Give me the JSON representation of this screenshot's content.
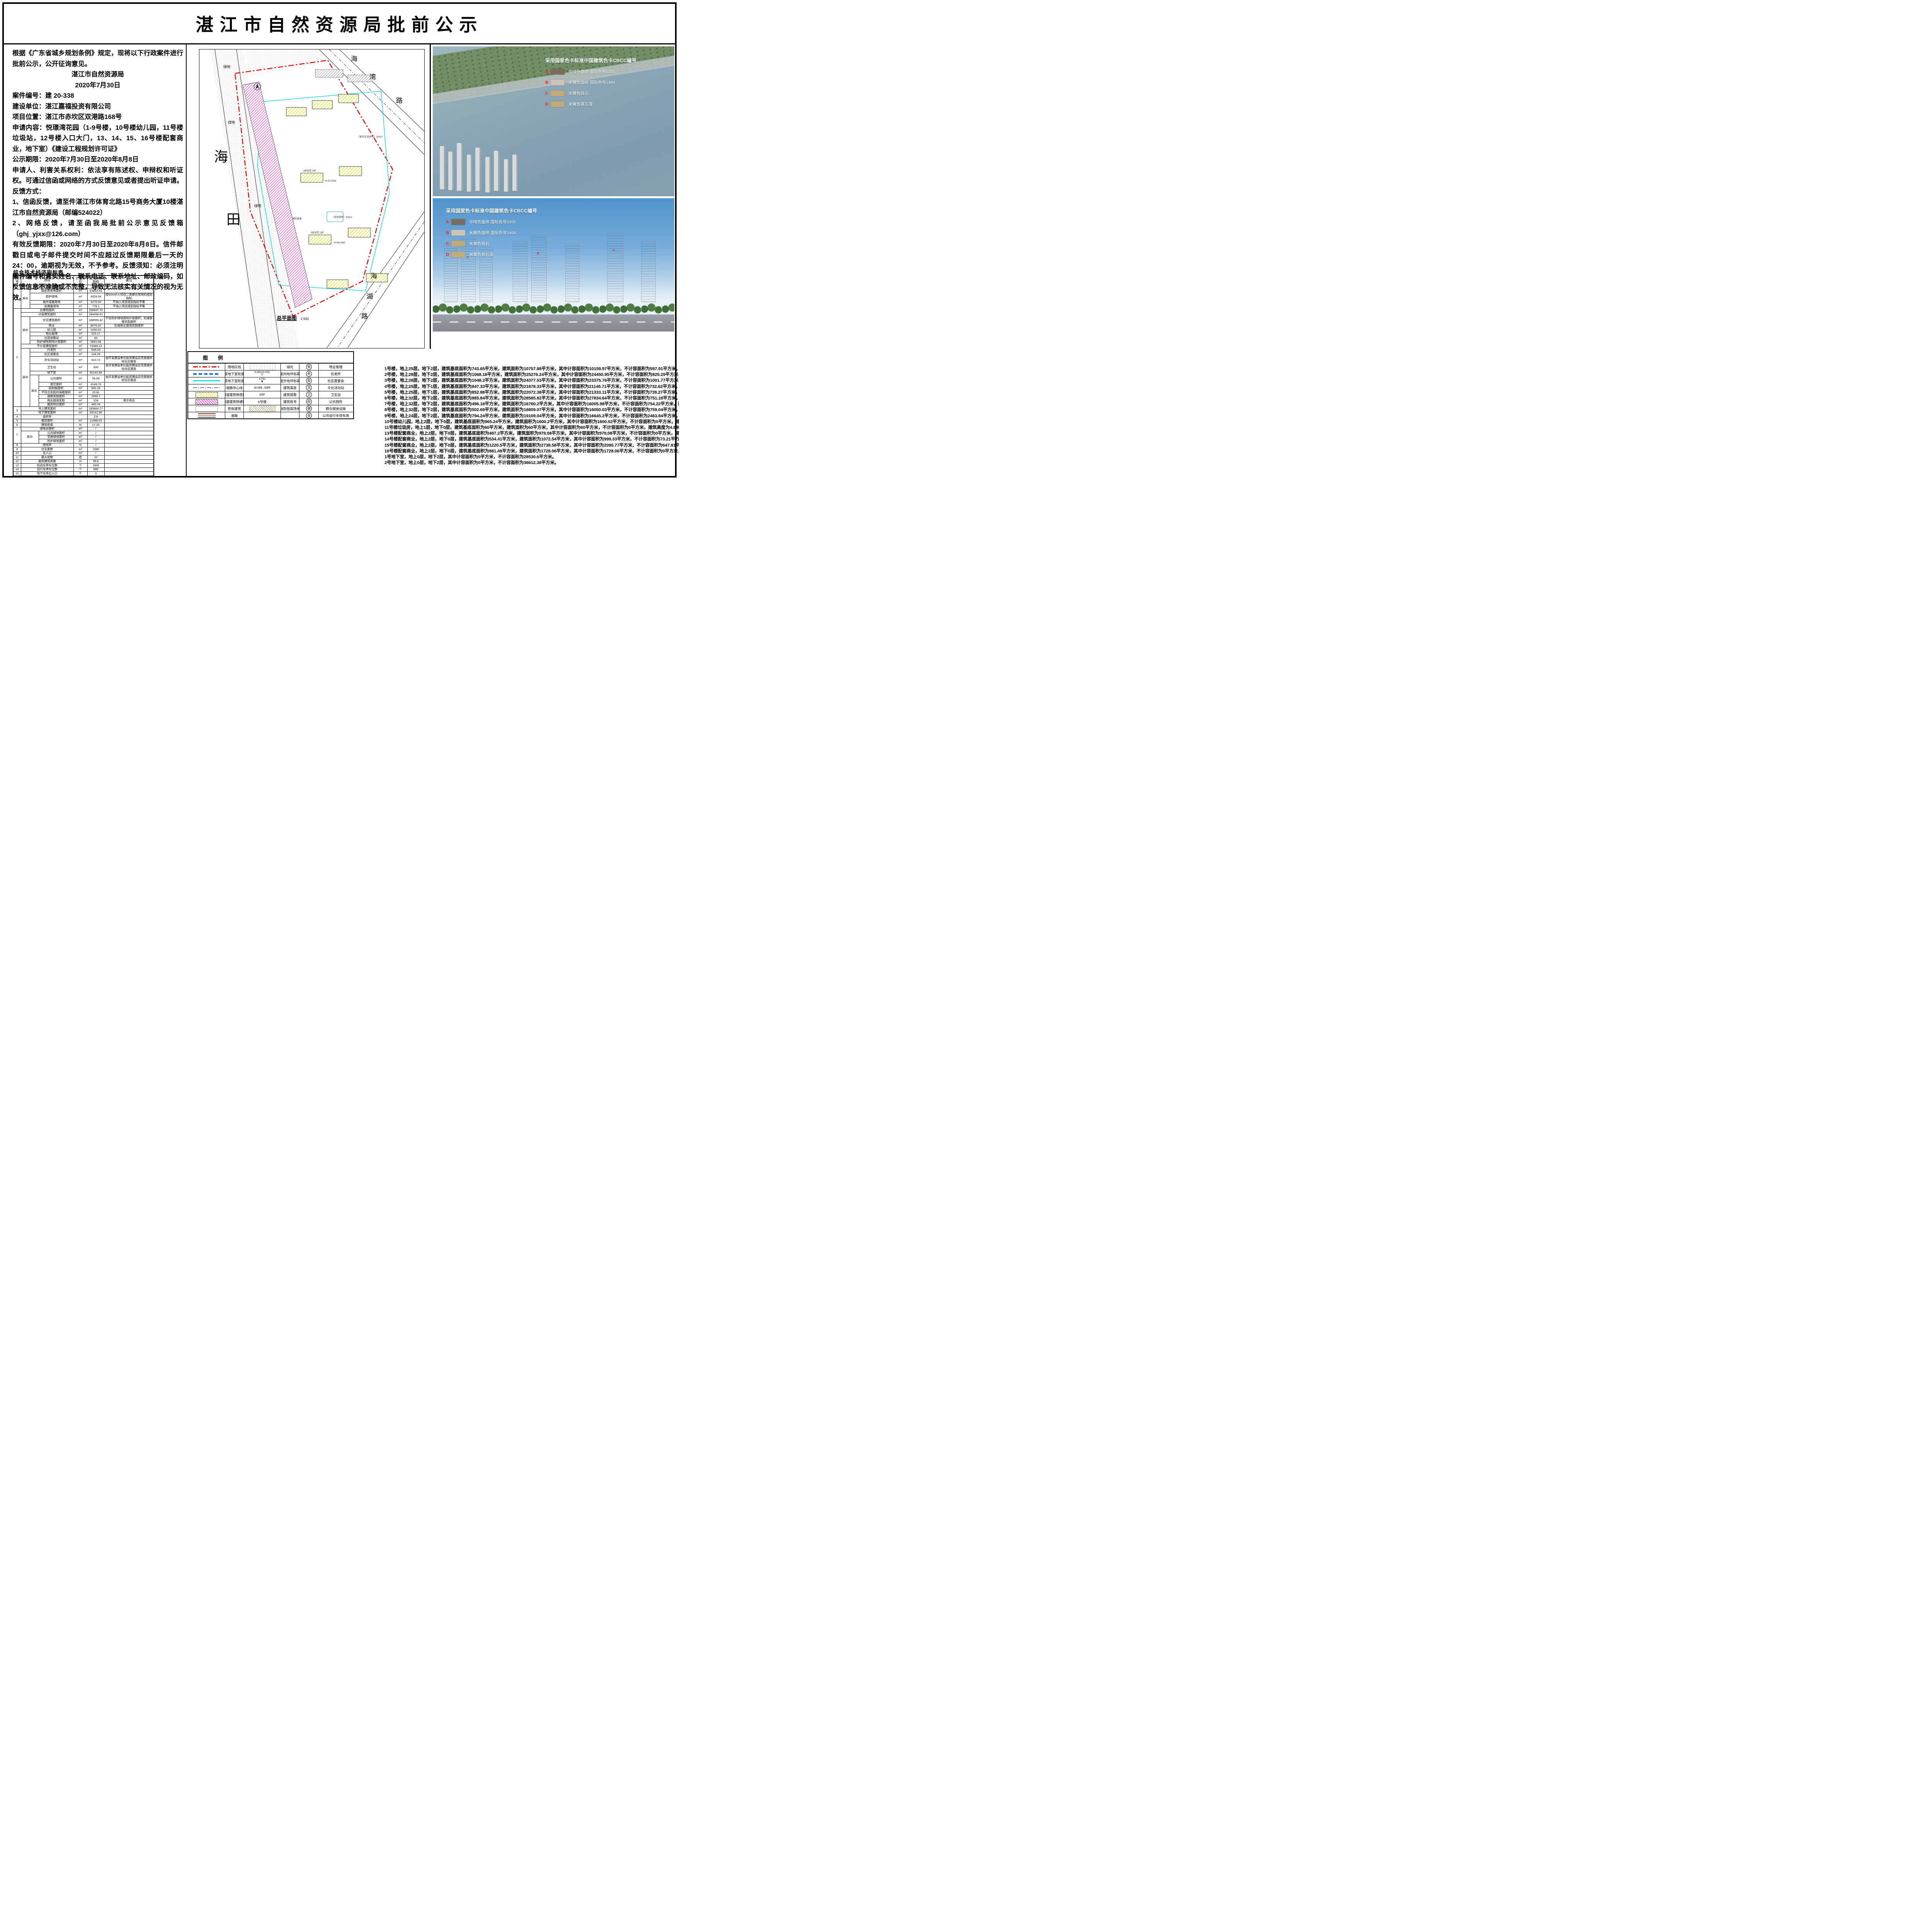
{
  "header": {
    "title": "湛江市自然资源局批前公示"
  },
  "notice": {
    "paras": [
      {
        "b": "",
        "t": "根据《广东省城乡规划条例》规定，现将以下行政案件进行批前公示，公开征询意见。",
        "align": "left"
      },
      {
        "b": "",
        "t": "湛江市自然资源局",
        "align": "center"
      },
      {
        "b": "",
        "t": "2020年7月30日",
        "align": "center"
      },
      {
        "b": "案件编号：",
        "t": "建 20-338",
        "align": "left"
      },
      {
        "b": "建设单位：",
        "t": "湛江嘉福投资有限公司",
        "align": "left"
      },
      {
        "b": "项目位置：",
        "t": "湛江市赤坎区双港路168号",
        "align": "left"
      },
      {
        "b": "申请内容：",
        "t": "悦璟湾花园（1-9号楼，10号楼幼儿园，11号楼垃圾站，12号楼入口大门，13、14、15、16号楼配套商业，地下室）《建设工程规划许可证》",
        "align": "left"
      },
      {
        "b": "公示期限：",
        "t": "2020年7月30日至2020年8月8日",
        "align": "left"
      },
      {
        "b": "",
        "t": "申请人、利害关系权利：依法享有陈述权、申辩权和听证权。可通过信函或网络的方式反馈意见或者提出听证申请。",
        "align": "left"
      },
      {
        "b": "反馈方式：",
        "t": "",
        "align": "left"
      },
      {
        "b": "",
        "t": "1、信函反馈，请至件湛江市体育北路15号商务大厦10楼湛江市自然资源局（邮编524022）",
        "align": "left"
      },
      {
        "b": "",
        "t": "2、网络反馈，请至函我局批前公示意见反馈箱（ghj_yjxx@126.com）",
        "align": "left"
      },
      {
        "b": "",
        "t": "有效反馈期限：2020年7月30日至2020年8月8日。信件邮戳日或电子邮件提交时间不应超过反馈期限最后一天的24：00，逾期视为无效，不予参考。反馈须知：必须注明案件编号和真实姓名、联系电话、联系地址、邮政编码，如反馈信息不准确或不完整，导致无法核实有关情况的视为无效。",
        "align": "left"
      }
    ]
  },
  "indicator_table": {
    "title": "综合技术经济指标表",
    "headers": [
      {
        "t": "序号"
      },
      {
        "t": "项目",
        "cs": 3
      },
      {
        "t": "计量单位"
      },
      {
        "t": "建筑单体指标"
      },
      {
        "t": "备注"
      }
    ],
    "rows": [
      [
        {
          "t": "1",
          "rs": 5
        },
        {
          "t": "项目总规划用地面积",
          "cs": 3
        },
        {
          "t": "m²"
        },
        {
          "t": "71946"
        },
        {
          "t": ""
        }
      ],
      [
        {
          "t": "其中",
          "rs": 4
        },
        {
          "t": "规划净用地面积",
          "cs": 2
        },
        {
          "t": "m²"
        },
        {
          "t": "63863.53"
        },
        {
          "t": ""
        }
      ],
      [
        {
          "t": "防护绿地",
          "cs": 2
        },
        {
          "t": "m²"
        },
        {
          "t": "4029.34"
        },
        {
          "t": "按50%计入项目二类居住用地的规划指标"
        }
      ],
      [
        {
          "t": "城市道路用地",
          "cs": 2
        },
        {
          "t": "m²"
        },
        {
          "t": "3275.03"
        },
        {
          "t": "不纳入项目规划指标平衡"
        }
      ],
      [
        {
          "t": "发展备用地",
          "cs": 2
        },
        {
          "t": "m²"
        },
        {
          "t": "778.1"
        },
        {
          "t": "不纳入项目规划指标平衡"
        }
      ],
      [
        {
          "t": "2",
          "rs": 21
        },
        {
          "t": "总建筑面积",
          "cs": 3
        },
        {
          "t": "m²"
        },
        {
          "t": "258947.75"
        },
        {
          "t": ""
        }
      ],
      [
        {
          "t": "计容建筑面积",
          "cs": 3
        },
        {
          "t": "m²"
        },
        {
          "t": "184458.61"
        },
        {
          "t": ""
        }
      ],
      [
        {
          "t": "其中",
          "rs": 6
        },
        {
          "t": "住宅建筑面积",
          "cs": 2
        },
        {
          "t": "m²"
        },
        {
          "t": "168555.42"
        },
        {
          "t": "不含防护绿地用地计容面积，扣减骑楼奖励面积"
        }
      ],
      [
        {
          "t": "商业",
          "cs": 2
        },
        {
          "t": "m²"
        },
        {
          "t": "8076.92"
        },
        {
          "t": "扣减商业烟道奖励面积"
        }
      ],
      [
        {
          "t": "幼儿园",
          "cs": 2
        },
        {
          "t": "m²"
        },
        {
          "t": "1600.02"
        },
        {
          "t": ""
        }
      ],
      [
        {
          "t": "物业管理",
          "cs": 2
        },
        {
          "t": "m²"
        },
        {
          "t": "525.17"
        },
        {
          "t": ""
        }
      ],
      [
        {
          "t": "垃圾收集站",
          "cs": 2
        },
        {
          "t": "m²"
        },
        {
          "t": "60"
        },
        {
          "t": ""
        }
      ],
      [
        {
          "t": "防护绿地用地计容面积",
          "cs": 2
        },
        {
          "t": "m²"
        },
        {
          "t": "5641.08"
        },
        {
          "t": ""
        }
      ],
      [
        {
          "t": "不计容建筑面积",
          "cs": 3
        },
        {
          "t": "m²"
        },
        {
          "t": "74489.14"
        },
        {
          "t": ""
        }
      ],
      [
        {
          "t": "其中",
          "rs": 12
        },
        {
          "t": "托老所",
          "cs": 2
        },
        {
          "t": "m²"
        },
        {
          "t": "506.59"
        },
        {
          "t": ""
        }
      ],
      [
        {
          "t": "社区居委会",
          "cs": 2
        },
        {
          "t": "m²"
        },
        {
          "t": "104.29"
        },
        {
          "t": ""
        }
      ],
      [
        {
          "t": "文化活动站",
          "cs": 2
        },
        {
          "t": "m²"
        },
        {
          "t": "410.72"
        },
        {
          "t": "由开发建设单位投资建设且无偿提供给社区服务"
        }
      ],
      [
        {
          "t": "卫生站",
          "cs": 2
        },
        {
          "t": "m²"
        },
        {
          "t": "300"
        },
        {
          "t": "由开发建设单位投资建设且无偿提供给社区服务"
        }
      ],
      [
        {
          "t": "地下室",
          "cs": 2
        },
        {
          "t": "m²"
        },
        {
          "t": "65142.98"
        },
        {
          "t": ""
        }
      ],
      [
        {
          "t": "其中",
          "rs": 7
        },
        {
          "t": "公共厕所"
        },
        {
          "t": "m²"
        },
        {
          "t": "55.69"
        },
        {
          "t": "由开发建设单位投资建设且无偿提供给社区服务"
        }
      ],
      [
        {
          "t": "架空面积"
        },
        {
          "t": "m²"
        },
        {
          "t": "4148.76"
        },
        {
          "t": ""
        }
      ],
      [
        {
          "t": "结构板面积"
        },
        {
          "t": "m²"
        },
        {
          "t": "692.16"
        },
        {
          "t": ""
        }
      ],
      [
        {
          "t": "不符合奖励的骑楼面积"
        },
        {
          "t": "m²"
        },
        {
          "t": "20.81"
        },
        {
          "t": ""
        }
      ],
      [
        {
          "t": "骑楼奖励面积"
        },
        {
          "t": "m²"
        },
        {
          "t": "2560.7"
        },
        {
          "t": ""
        }
      ],
      [
        {
          "t": "商业烟道奖励"
        },
        {
          "t": "m²"
        },
        {
          "t": "104"
        },
        {
          "t": "用于商业"
        }
      ],
      [
        {
          "t": "服务阳台面积"
        },
        {
          "t": "m²"
        },
        {
          "t": "442.44"
        },
        {
          "t": ""
        }
      ],
      [
        {
          "t": "3",
          "rs": 2
        },
        {
          "t": "地上建筑面积",
          "cs": 3
        },
        {
          "t": "m²"
        },
        {
          "t": "193804.77"
        },
        {
          "t": ""
        }
      ],
      [
        {
          "t": "地下建筑面积",
          "cs": 3
        },
        {
          "t": "m²"
        },
        {
          "t": "65142.98"
        },
        {
          "t": ""
        }
      ],
      [
        {
          "t": "4"
        },
        {
          "t": "容积率",
          "cs": 3
        },
        {
          "t": ""
        },
        {
          "t": "2.8"
        },
        {
          "t": ""
        }
      ],
      [
        {
          "t": "5"
        },
        {
          "t": "基底面积",
          "cs": 3
        },
        {
          "t": "m²"
        },
        {
          "t": "11388.03"
        },
        {
          "t": ""
        }
      ],
      [
        {
          "t": "6"
        },
        {
          "t": "建筑密度",
          "cs": 3
        },
        {
          "t": "%"
        },
        {
          "t": "17.25"
        },
        {
          "t": ""
        }
      ],
      [
        {
          "t": "7",
          "rs": 4
        },
        {
          "t": "绿地总面积",
          "cs": 3
        },
        {
          "t": "m²"
        },
        {
          "t": "/"
        },
        {
          "t": ""
        }
      ],
      [
        {
          "t": "其中",
          "rs": 3,
          "cs": 2
        },
        {
          "t": "公共绿地面积"
        },
        {
          "t": "m²"
        },
        {
          "t": "/"
        },
        {
          "t": ""
        }
      ],
      [
        {
          "t": "宅旁绿地面积"
        },
        {
          "t": "m²"
        },
        {
          "t": "/"
        },
        {
          "t": ""
        }
      ],
      [
        {
          "t": "防护绿地面积"
        },
        {
          "t": "m²"
        },
        {
          "t": "/"
        },
        {
          "t": ""
        }
      ],
      [
        {
          "t": "8"
        },
        {
          "t": "绿地率",
          "cs": 3
        },
        {
          "t": "%"
        },
        {
          "t": "/"
        },
        {
          "t": ""
        }
      ],
      [
        {
          "t": "9"
        },
        {
          "t": "住宅套数",
          "cs": 3
        },
        {
          "t": "m²"
        },
        {
          "t": "1590"
        },
        {
          "t": ""
        }
      ],
      [
        {
          "t": "10"
        },
        {
          "t": "总人口",
          "cs": 3
        },
        {
          "t": "m²"
        },
        {
          "t": "/"
        },
        {
          "t": ""
        }
      ],
      [
        {
          "t": "11"
        },
        {
          "t": "最大层数",
          "cs": 3
        },
        {
          "t": "层"
        },
        {
          "t": "32"
        },
        {
          "t": ""
        }
      ],
      [
        {
          "t": "12"
        },
        {
          "t": "最高建筑高度",
          "cs": 3
        },
        {
          "t": "m"
        },
        {
          "t": "99.9"
        },
        {
          "t": ""
        }
      ],
      [
        {
          "t": "13"
        },
        {
          "t": "机动车停车位数",
          "cs": 3
        },
        {
          "t": "个"
        },
        {
          "t": "1900"
        },
        {
          "t": ""
        }
      ],
      [
        {
          "t": "14"
        },
        {
          "t": "自行车停车位数",
          "cs": 3
        },
        {
          "t": "个"
        },
        {
          "t": "995"
        },
        {
          "t": ""
        }
      ],
      [
        {
          "t": "15"
        },
        {
          "t": "地下车库出入口",
          "cs": 3
        },
        {
          "t": "个"
        },
        {
          "t": "3"
        },
        {
          "t": ""
        }
      ]
    ]
  },
  "plan": {
    "caption": "总平面图",
    "scale": "1:500",
    "road_top": [
      "海",
      "湾",
      "路"
    ],
    "road_left": [
      "海",
      "田"
    ],
    "road_bottom": [
      "海",
      "湖",
      "路"
    ],
    "green": "绿地",
    "annotations": [
      "2栋住宅 29F",
      "H=91.50M",
      "3栋住宅 28F",
      "H=88.50M",
      "（室外交流场所）300㎡",
      "（活动场所）638㎡",
      "消防通道"
    ]
  },
  "legend": {
    "title": "图例",
    "symtext": {
      "lvl_in": "9.350(±0.000)",
      "lvl_out": "6.750",
      "h": "H=88.50M",
      "f": "28F",
      "bld": "6号楼"
    },
    "rows": [
      {
        "s1": "red-dash",
        "l1": "用地红线",
        "s2": "green",
        "l2": "绿化",
        "c": "物",
        "l3": "物业管理"
      },
      {
        "s1": "blue-dash",
        "l1": "一层地下室轮廓线",
        "s2": "lvl-in",
        "l2": "室内地坪标高",
        "c": "老",
        "l3": "托老所"
      },
      {
        "s1": "cyan-solid",
        "l1": "二层地下室轮廓线",
        "s2": "lvl-out",
        "l2": "室外地坪标高",
        "c": "居",
        "l3": "社区居委会"
      },
      {
        "s1": "dashdot",
        "l1": "道路中心线",
        "s2": "txt-h",
        "l2": "建筑高度",
        "c": "活",
        "l3": "文化活动站"
      },
      {
        "s1": "hatch-yellow",
        "l1": "拟建建筑物塔楼",
        "s2": "txt-28f",
        "l2": "建筑层数",
        "c": "卫",
        "l3": "卫生站"
      },
      {
        "s1": "hatch-magenta",
        "l1": "拟建建筑物裙楼",
        "s2": "txt-6",
        "l2": "建筑栋号",
        "c": "厕",
        "l3": "公共厕所"
      },
      {
        "s1": "rect-white",
        "l1": "原有建筑",
        "s2": "hatch-gray",
        "l2": "消防登高场地",
        "c": "健",
        "l3": "群众健身设施"
      },
      {
        "s1": "road",
        "l1": "道路",
        "s2": "",
        "l2": "",
        "c": "自",
        "l3": "公共自行车停车场"
      }
    ]
  },
  "renders": {
    "legend_title": "采用国家色卡标准中国建筑色卡CBCC编号",
    "items": [
      {
        "key": "A",
        "color": "#7b6c5b",
        "label": "中啡色面砖  国际色号0205"
      },
      {
        "key": "B",
        "color": "#cdc4b9",
        "label": "米黄色面砖 国际色号1464"
      },
      {
        "key": "C",
        "color": "#c2a97b",
        "label": "米黄色挂石"
      },
      {
        "key": "D",
        "color": "#c3aa79",
        "label": "米黄色真石漆"
      }
    ]
  },
  "buildings": {
    "lines": [
      "1号楼，地上25层，地下2层，建筑基底面积为743.65平方米，建筑面积为10757.88平方米，其中计容面积为10159.97平方米，不计容面积为597.91平方米，建筑高度为79.7米。",
      "2号楼，地上29层，地下2层，建筑基底面积为1068.18平方米，建筑面积为25276.24平方米，其中计容面积为24450.95平方米，不计容面积为825.29平方米，建筑高度为91.5米。",
      "3号楼，地上28层，地下2层，建筑基底面积为1048.2平方米，建筑面积为24377.53平方米，其中计容面积为23375.76平方米，不计容面积为1001.77平方米，建筑高度为88.5米。",
      "4号楼，地上25层，地下1层，建筑基底面积为847.33平方米，建筑面积为21878.33平方米，其中计容面积为21145.71平方米，不计容面积为732.62平方米，建筑高度为79米。",
      "5号楼，地上25层，地下1层，建筑基底面积为852.88平方米，建筑面积为22072.38平方米，其中计容面积为21333.11平方米，不计容面积为739.27平方米，建筑高度为79米。",
      "6号楼，地上32层，地下2层，建筑基底面积为885.84平方米，建筑面积为28585.82平方米，其中计容面积为27834.64平方米，不计容面积为751.18平方米，建筑高度为99.9米。",
      "7号楼，地上32层，地下2层，建筑基底面积为496.18平方米，建筑面积为16760.2平方米，其中计容面积为16005.98平方米，不计容面积为754.22平方米，建筑高度为99.9米。",
      "8号楼，地上32层，地下2层，建筑基底面积为502.69平方米，建筑面积为16809.07平方米，其中计容面积为16050.03平方米，不计容面积为759.04平方米，建筑高度为99.9米。",
      "9号楼，地上24层，地下2层，建筑基底面积为794.24平方米，建筑面积为19109.04平方米，其中计容面积为16645.2平方米，不计容面积为2463.84平方米，建筑高度为76米。",
      "10号楼幼儿园，地上2层，地下0层，建筑基底面积为965.24平方米，建筑面积为1600.2平方米，其中计容面积为1600.02平方米，不计容面积为0平方米，建筑高度为9.6米。",
      "11号楼垃圾房，地上1层，地下0层，建筑基底面积为60平方米，建筑面积为60平方米，其中计容面积为60平方米，不计容面积为0平方米，建筑高度为4.8米。",
      "13号楼配套商业，地上2层，地下0层，建筑基底面积为487.2平方米，建筑面积为979.08平方米，其中计容面积为979.08平方米，不计容面积为0平方米，建筑高度为11.25米。",
      "14号楼配套商业，地上2层，地下0层，建筑基底面积为534.41平方米，建筑面积为1072.54平方米，其中计容面积为999.33平方米，不计容面积为73.21平方米，建筑高度为11.25米。",
      "15号楼配套商业，地上2层，地下0层，建筑基底面积为1220.5平方米，建筑面积为2738.58平方米，其中计容面积为2090.77平方米，不计容面积为647.81平方米，建筑高度为11.25米。",
      "16号楼配套商业，地上2层，地下0层，建筑基底面积为881.49平方米，建筑面积为1728.06平方米，其中计容面积为1728.06平方米，不计容面积为0平方米，建筑高度为11.25米。",
      "1号地下室，地上0层，地下2层，其中计容面积为0平方米，不计容面积为28530.6平方米。",
      "2号地下室，地上0层，地下2层，其中计容面积为0平方米，不计容面积为36612.38平方米。"
    ]
  }
}
